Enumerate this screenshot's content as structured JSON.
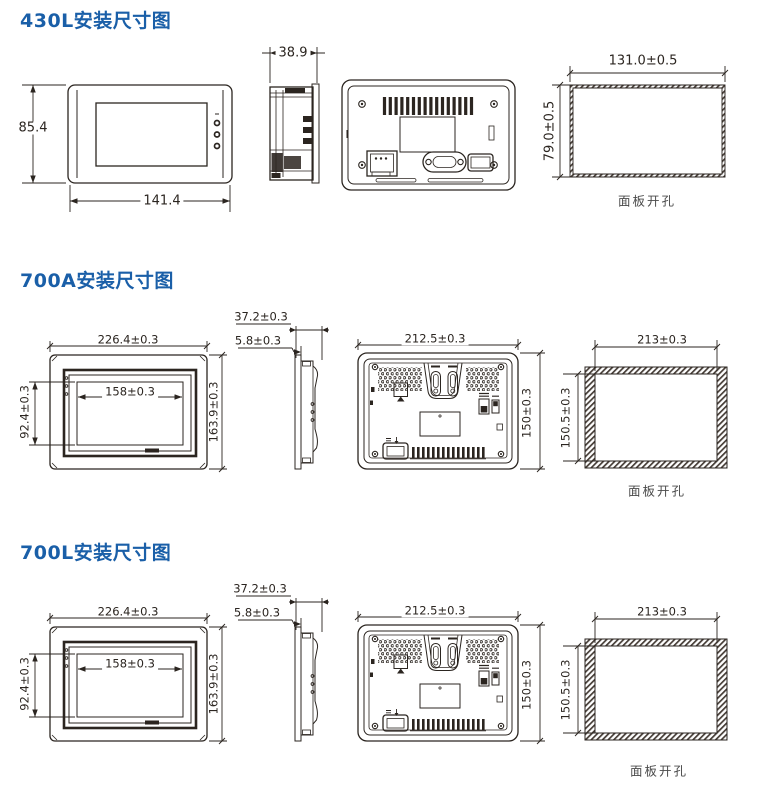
{
  "page": {
    "title_color": "#1a5fa8",
    "line_color": "#2b2520",
    "background": "#ffffff"
  },
  "sections": [
    {
      "model": "430L",
      "title": "430L安装尺寸图",
      "front_view": {
        "height_label": "85.4",
        "width_label": "141.4"
      },
      "side_view": {
        "depth_label": "38.9"
      },
      "panel_cutout": {
        "width_label": "131.0±0.5",
        "height_label": "79.0±0.5",
        "caption": "面板开孔"
      }
    },
    {
      "model": "700A",
      "title": "700A安装尺寸图",
      "front_view": {
        "width_label": "226.4±0.3",
        "height_label": "163.9±0.3",
        "screen_width_label": "158±0.3",
        "screen_height_label": "92.4±0.3"
      },
      "side_view": {
        "depth_label": "37.2±0.3",
        "bezel_label": "5.8±0.3"
      },
      "rear_view": {
        "width_label": "212.5±0.3",
        "height_label": "150±0.3"
      },
      "panel_cutout": {
        "width_label": "213±0.3",
        "height_label": "150.5±0.3",
        "caption": "面板开孔"
      }
    },
    {
      "model": "700L",
      "title": "700L安装尺寸图",
      "front_view": {
        "width_label": "226.4±0.3",
        "height_label": "163.9±0.3",
        "screen_width_label": "158±0.3",
        "screen_height_label": "92.4±0.3"
      },
      "side_view": {
        "depth_label": "37.2±0.3",
        "bezel_label": "5.8±0.3"
      },
      "rear_view": {
        "width_label": "212.5±0.3",
        "height_label": "150±0.3"
      },
      "panel_cutout": {
        "width_label": "213±0.3",
        "height_label": "150.5±0.3",
        "caption": "面板开孔"
      }
    }
  ]
}
